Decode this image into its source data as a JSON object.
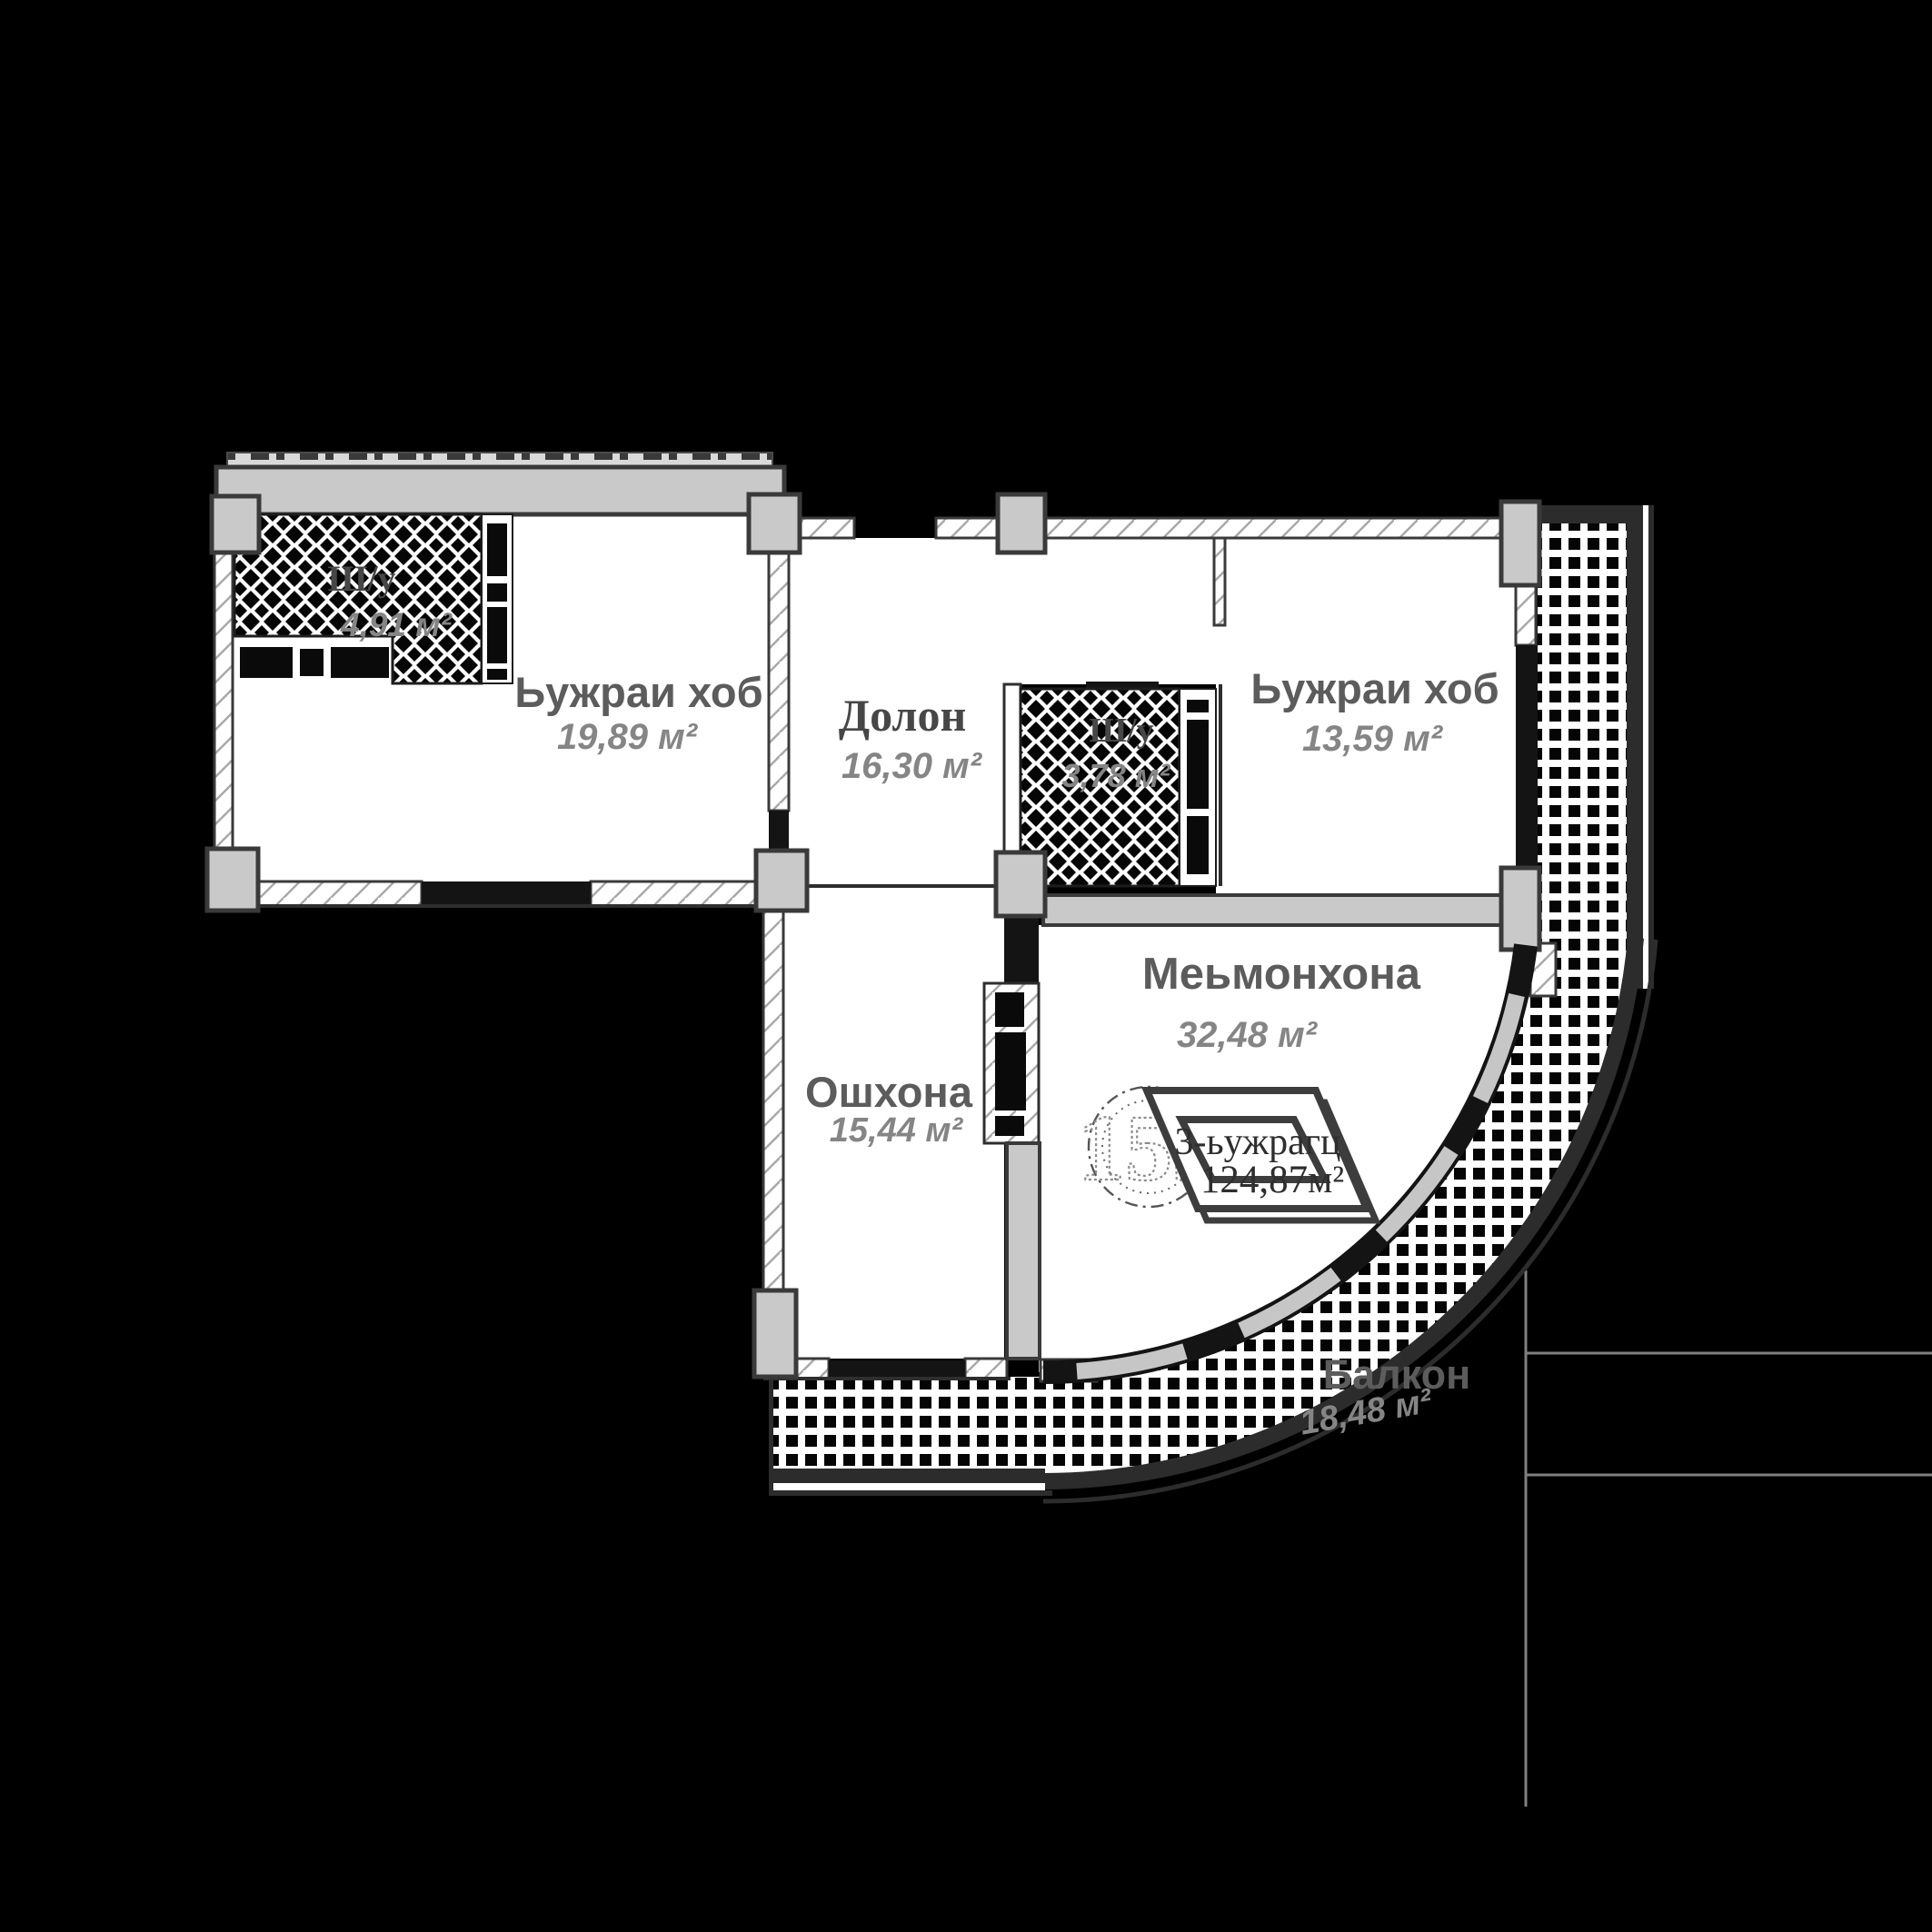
{
  "plan": {
    "title": "Apartment floor plan",
    "unit_badge": {
      "number": "155",
      "type_label": "3-ьужрагц",
      "total_area": "124,87м²"
    },
    "rooms": [
      {
        "id": "closet-1",
        "name": "Ш/у",
        "area": "4,91 м²"
      },
      {
        "id": "bedroom-1",
        "name": "Ьужраи хоб",
        "area": "19,89 м²"
      },
      {
        "id": "hallway",
        "name": "Долон",
        "area": "16,30 м²"
      },
      {
        "id": "closet-2",
        "name": "Ш/у",
        "area": "3,78 м²"
      },
      {
        "id": "bedroom-2",
        "name": "Ьужраи хоб",
        "area": "13,59 м²"
      },
      {
        "id": "living-room",
        "name": "Меьмонхона",
        "area": "32,48 м²"
      },
      {
        "id": "kitchen",
        "name": "Ошхона",
        "area": "15,44 м²"
      },
      {
        "id": "balcony",
        "name": "Балкон",
        "area": "18,48 м²"
      }
    ],
    "colors": {
      "background": "#000000",
      "floor": "#ffffff",
      "wall_fill": "#c9c9c9",
      "wall_outline": "#3a3a3a",
      "black_wall": "#141414",
      "room_name_text": "#5c5c5c",
      "area_text": "#858585"
    }
  }
}
